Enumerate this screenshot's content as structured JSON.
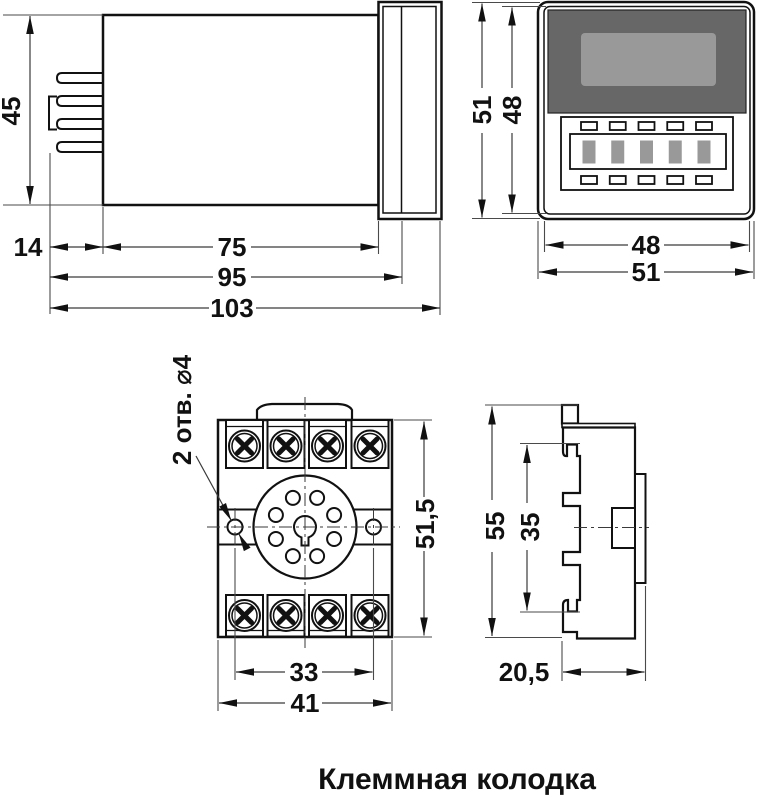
{
  "caption": "Клеммная колодка",
  "views": {
    "relay_side": {
      "dims": {
        "height": "45",
        "front": "14",
        "body": "75",
        "panel": "95",
        "total": "103"
      }
    },
    "relay_front": {
      "dims": {
        "outer_h": "51",
        "inner_h": "48",
        "inner_w": "48",
        "outer_w": "51"
      }
    },
    "socket_front": {
      "hole_note": "2 отв. ⌀4",
      "dims": {
        "height": "51,5",
        "holes": "33",
        "width": "41"
      }
    },
    "socket_side": {
      "dims": {
        "height": "55",
        "inner": "35",
        "depth": "20,5"
      }
    }
  },
  "colors": {
    "line": "#111111",
    "dim_line": "#3a3a3a",
    "display_dark": "#676767",
    "display_screen": "#999999",
    "button_gray": "#999999",
    "background": "#ffffff"
  }
}
